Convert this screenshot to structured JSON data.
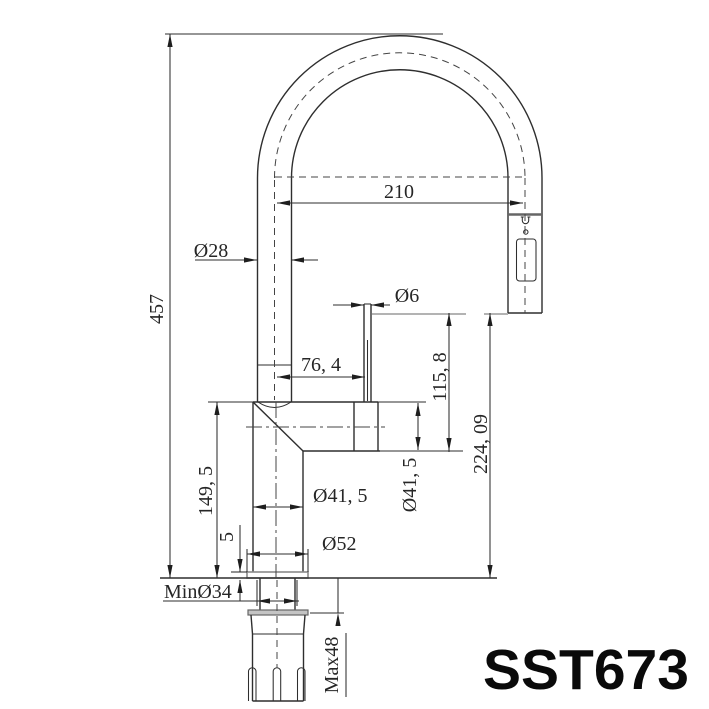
{
  "drawing": {
    "model": "SST673",
    "dims": {
      "overall_height": "457",
      "reach": "210",
      "spout_tube_dia": "Ø28",
      "hose_dia": "Ø6",
      "hose_offset": "76, 4",
      "outlet_height": "115, 8",
      "body_height": "149, 5",
      "outlet_to_deck": "224, 09",
      "body_dia": "Ø41, 5",
      "outlet_dia": "Ø41, 5",
      "base_dia": "Ø52",
      "base_plate_height": "5",
      "min_hole": "MinØ34",
      "max_deck_thickness": "Max48"
    },
    "colors": {
      "line": "#2e2e2e",
      "reference_gray": "#9a9a9a",
      "background": "#ffffff"
    }
  }
}
